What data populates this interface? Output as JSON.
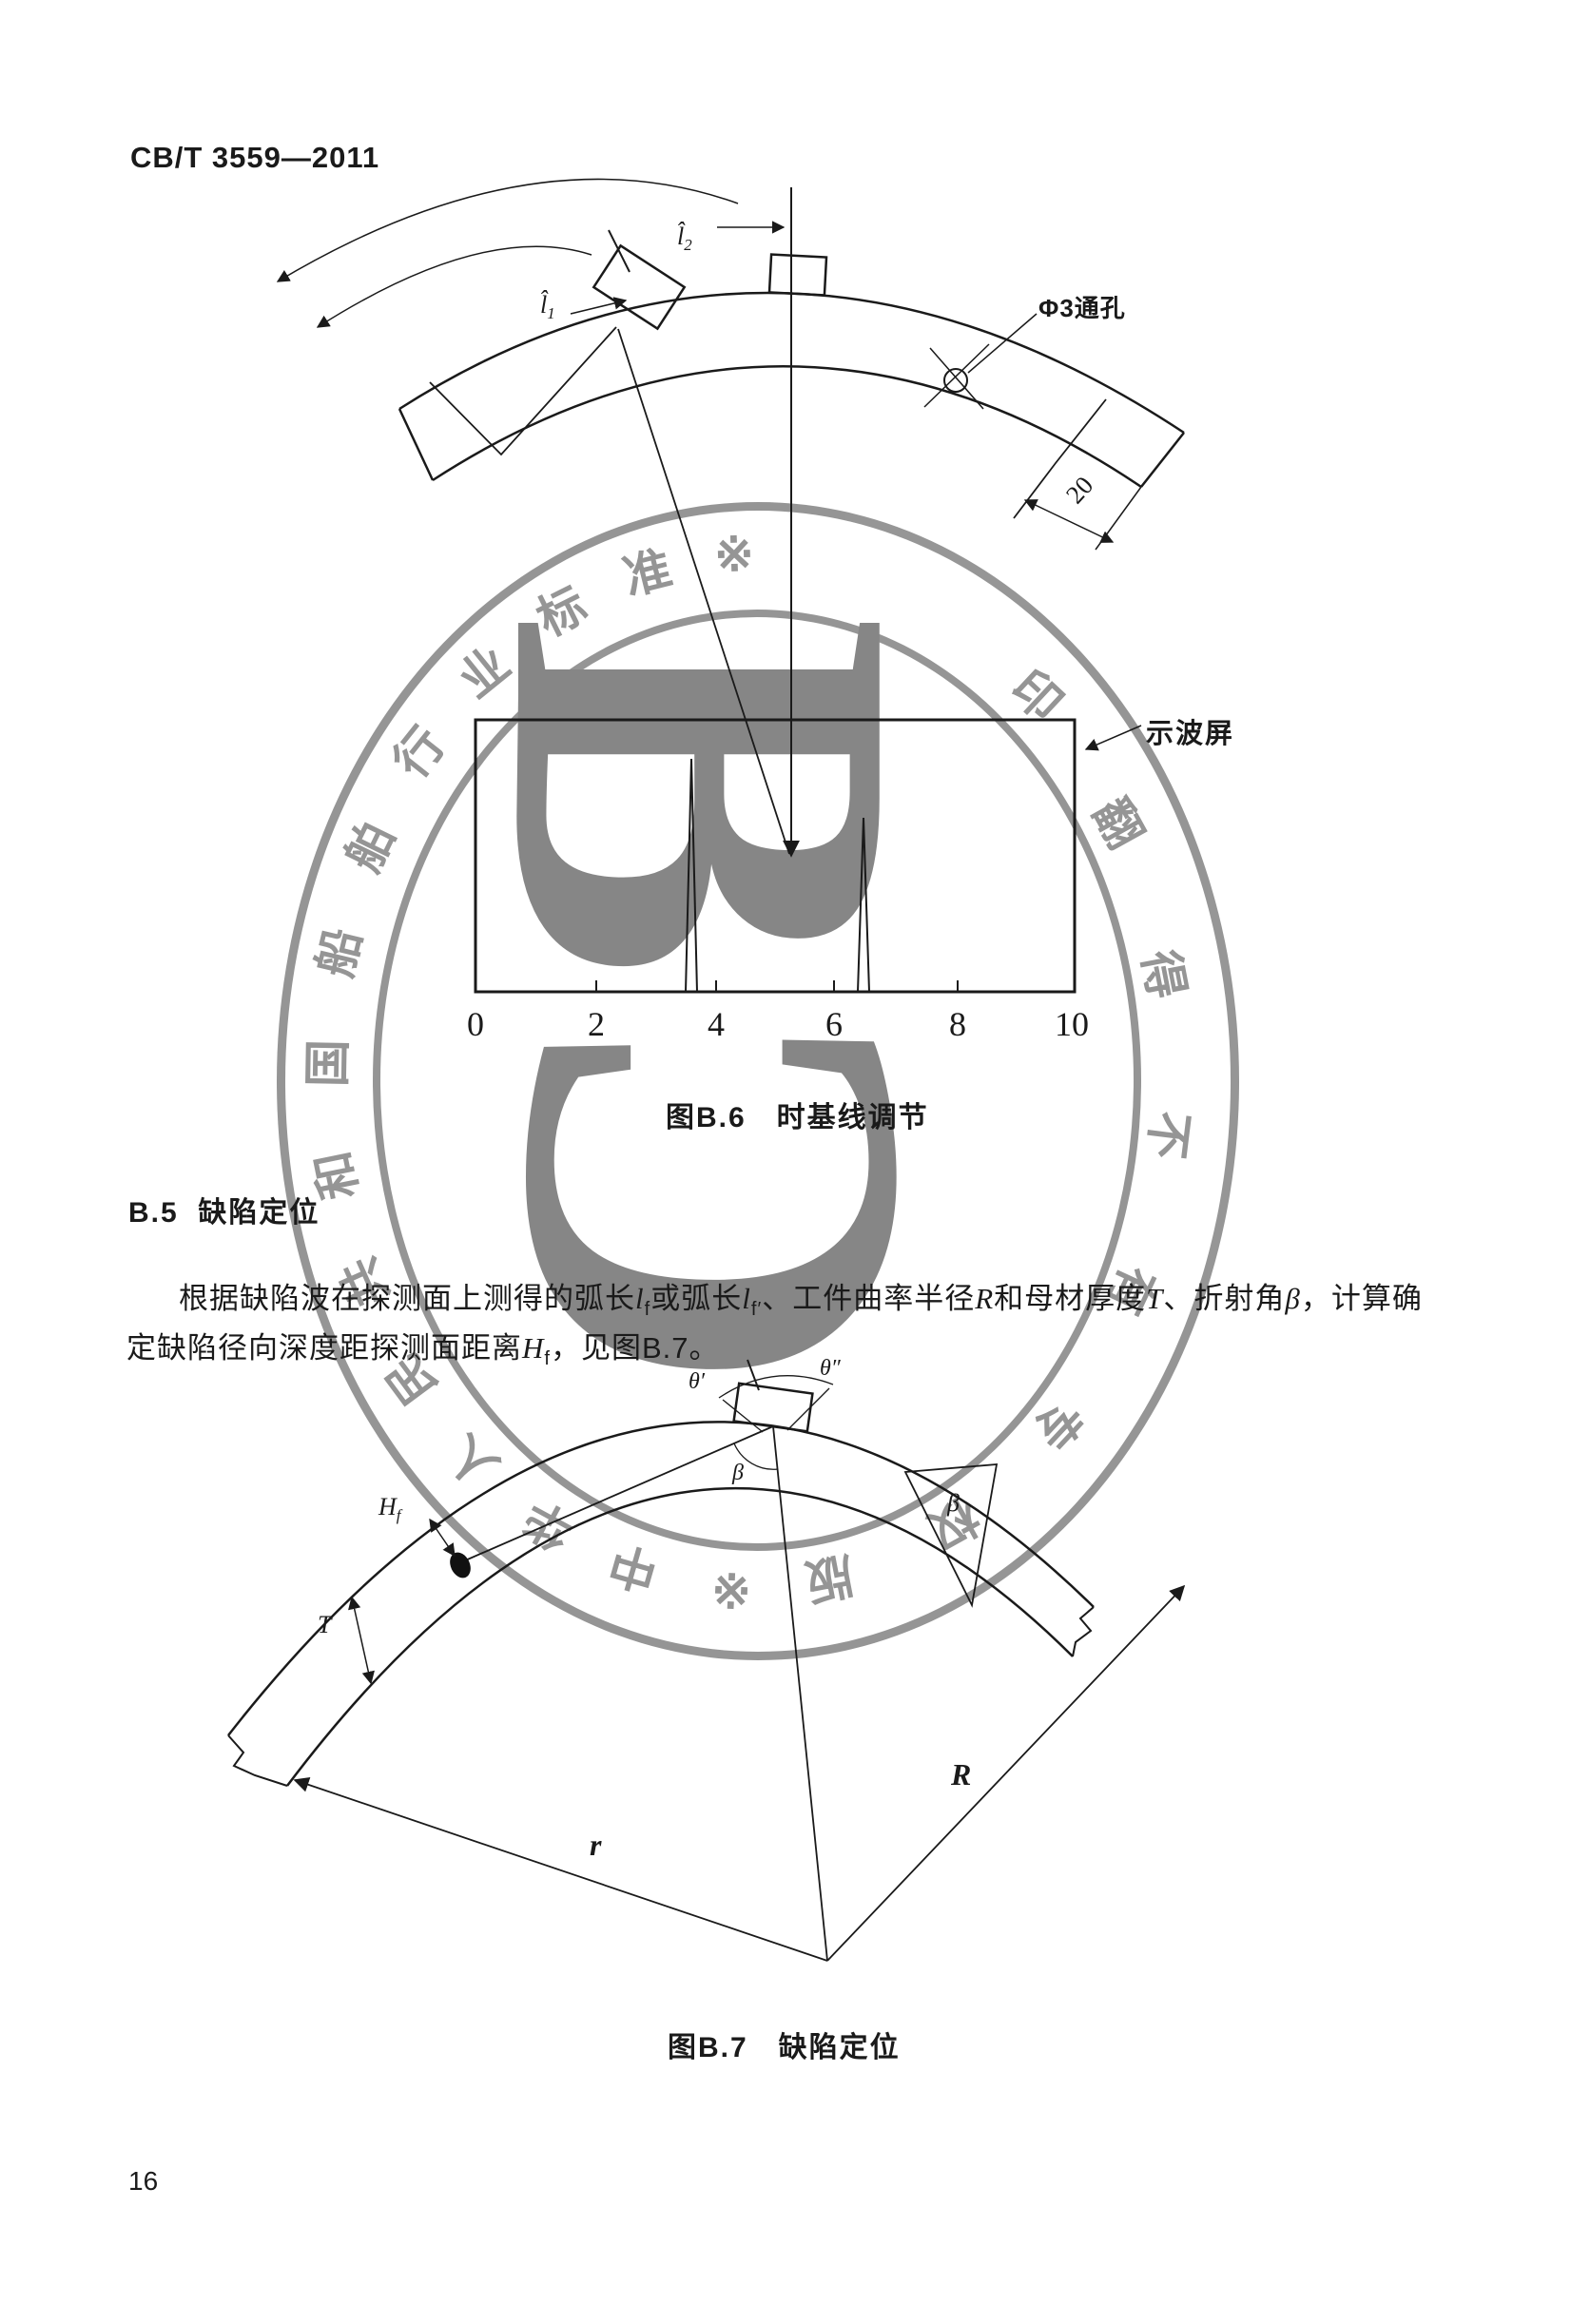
{
  "page": {
    "header": "CB/T 3559—2011",
    "page_number": "16"
  },
  "figure_b6": {
    "caption": "图B.6　时基线调节",
    "screen_label": "示波屏",
    "hole_label": "Φ3通孔",
    "end_width_dim": "20",
    "arc_len_1": {
      "base": "l̂",
      "sub": "1"
    },
    "arc_len_2": {
      "base": "l̂",
      "sub": "2"
    },
    "axis_ticks": [
      "0",
      "2",
      "4",
      "6",
      "8",
      "10"
    ]
  },
  "section_b5": {
    "heading_no": "B.5",
    "heading_title": "缺陷定位",
    "para": {
      "l1t1": "根据缺陷波在探测面上测得的弧长",
      "l1v1": "l",
      "l1s1": "f",
      "l1t2": "或弧长",
      "l1v2": "l",
      "l1s2": "f′",
      "l1t3": "、工件曲率半径",
      "l1v3": "R",
      "l1t4": "和母材厚度",
      "l1v4": "T",
      "l1t5": "、折射角",
      "l1v5": "β",
      "l1t6": "，计算确",
      "l2t1": "定缺陷径向深度距探测面距离",
      "l2v1": "H",
      "l2s1": "f",
      "l2t2": "，见图B.7。"
    }
  },
  "figure_b7": {
    "caption": "图B.7　缺陷定位",
    "theta_1": "θ′",
    "theta_2": "θ″",
    "beta_1": "β",
    "beta_2": "β",
    "depth_label": {
      "base": "H",
      "sub": "f"
    },
    "thickness_label": "T",
    "inner_radius_label": "r",
    "outer_radius_label": "R"
  },
  "watermark": {
    "left_text": "中华人民共和国船舶行业标准",
    "right_text": "版权专有不得翻印",
    "star": "※",
    "letter_top": "B",
    "letter_bottom": "C",
    "ring_color": "#8d8d8d",
    "letter_color": "#7c7c7c"
  }
}
